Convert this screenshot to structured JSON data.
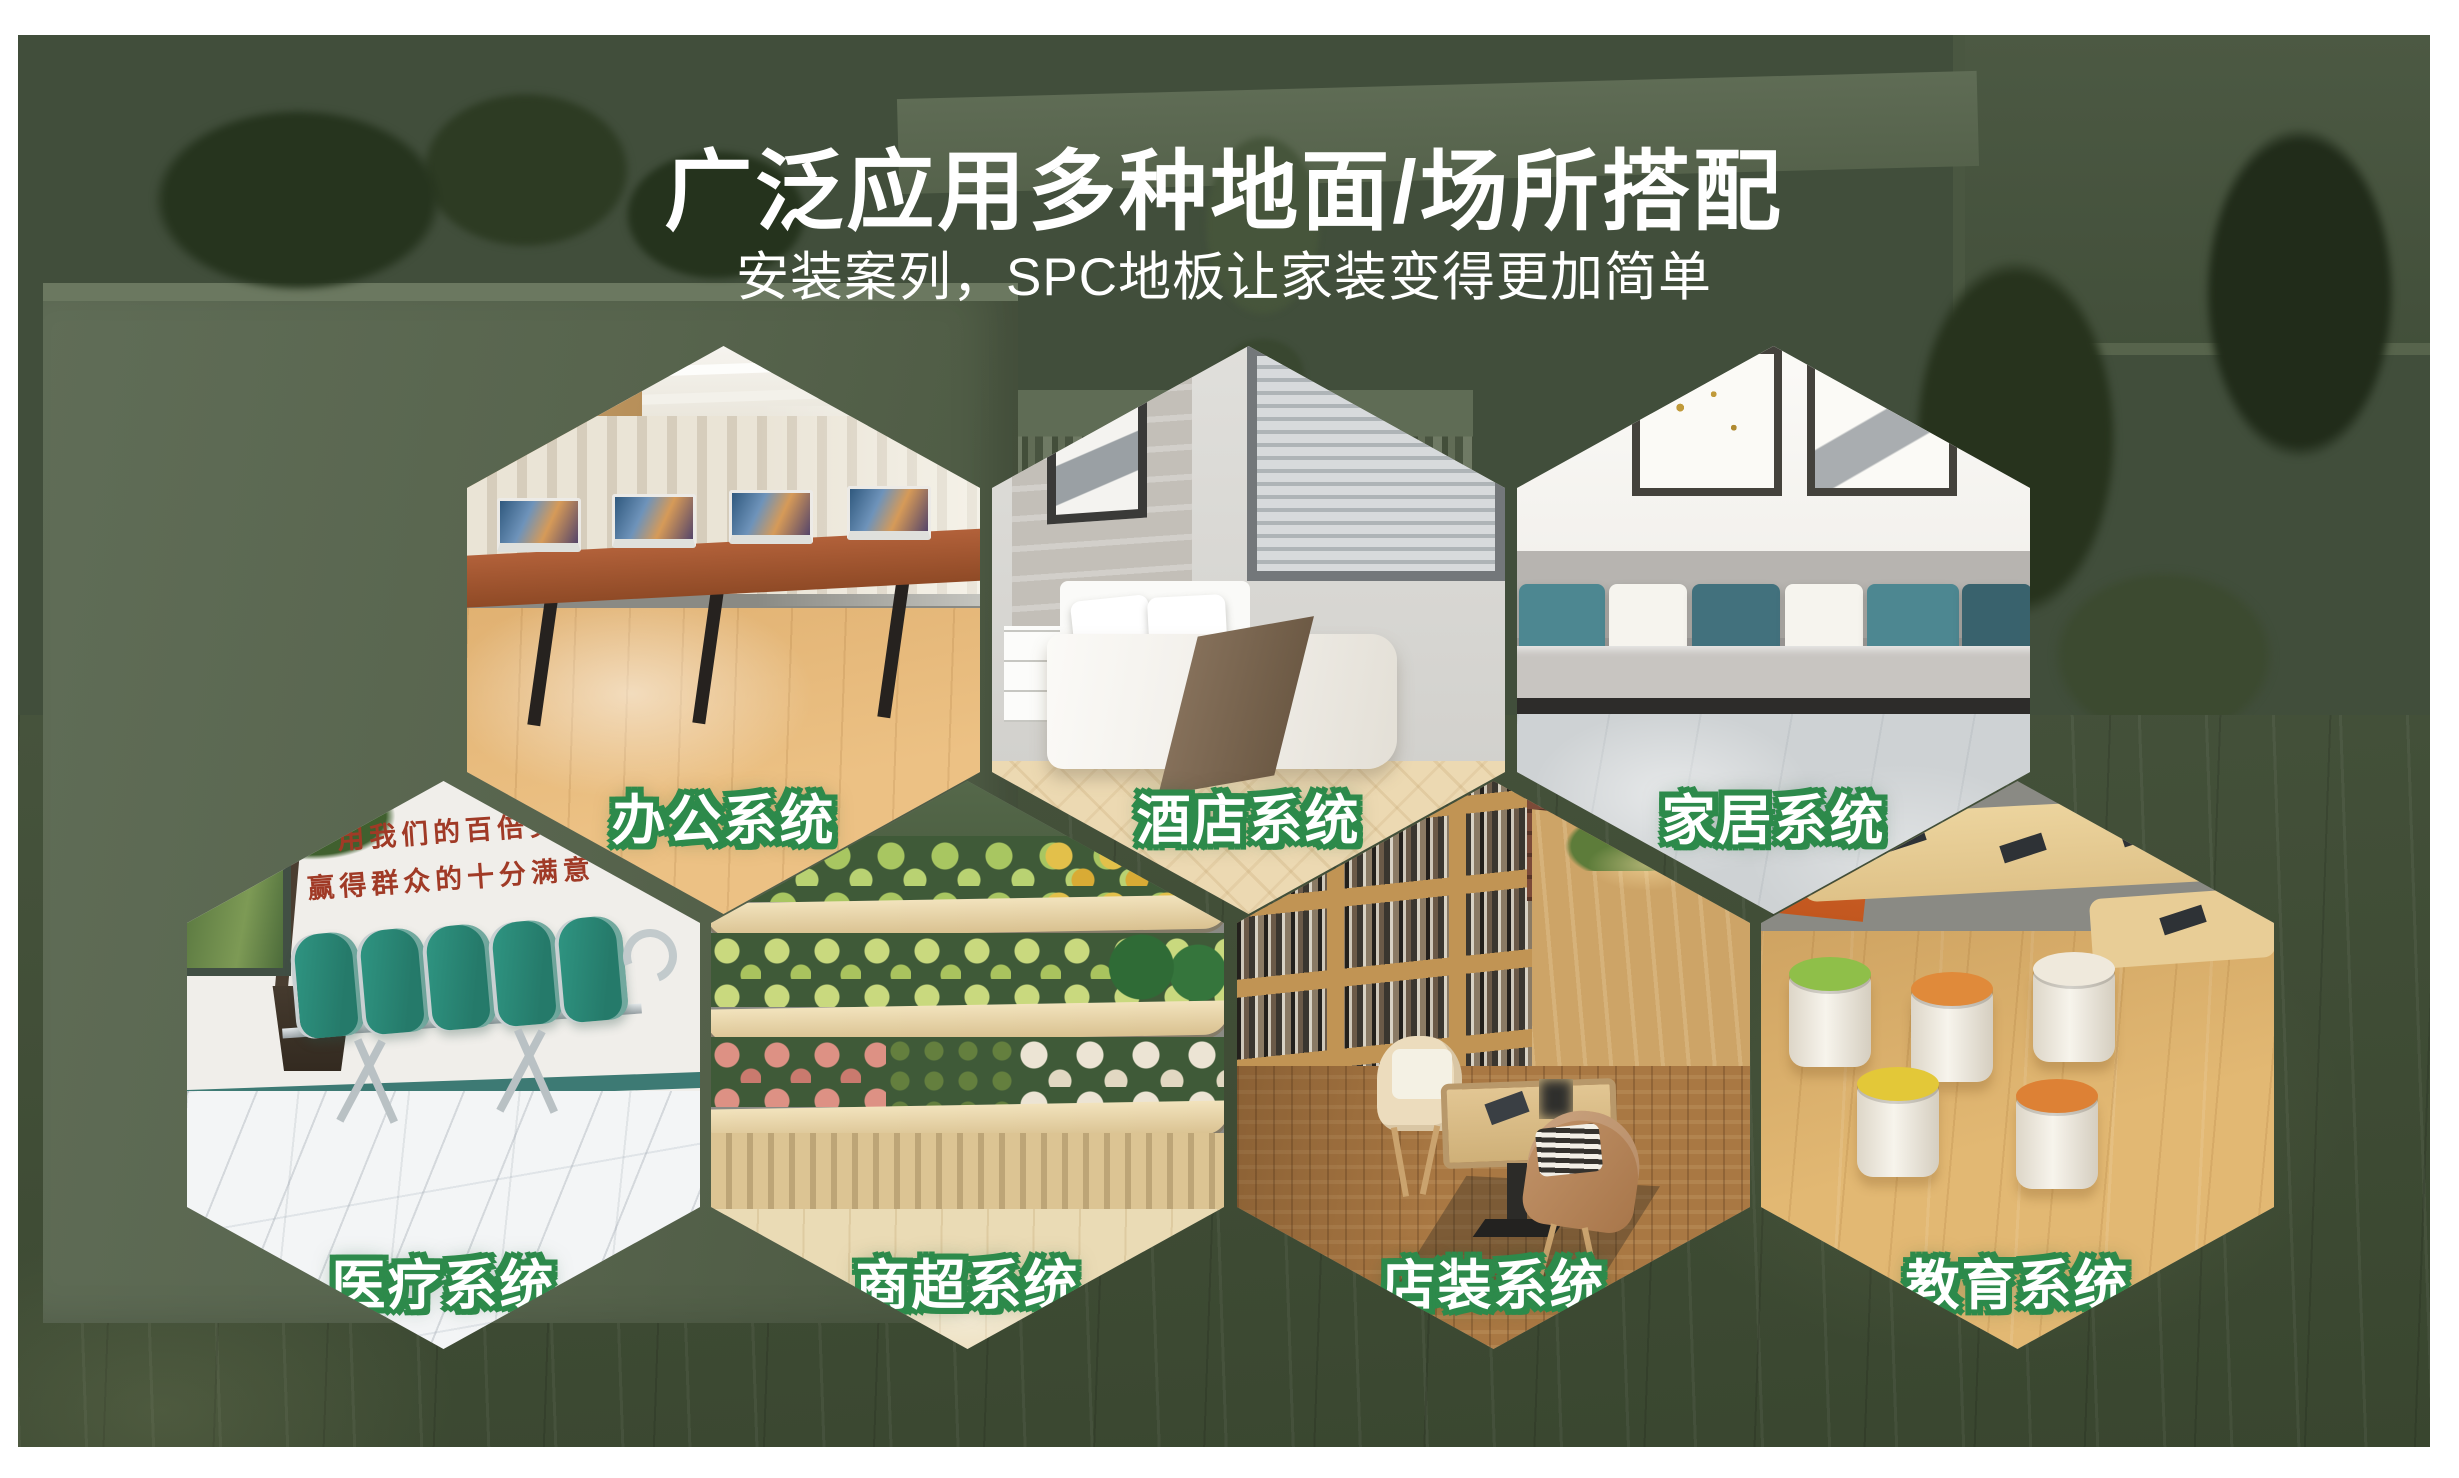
{
  "poster": {
    "title": "广泛应用多种地面/场所搭配",
    "subtitle": "安装案列，SPC地板让家装变得更加简单",
    "colors": {
      "accent_green": "#2d8a4b",
      "background_green": "#414e3b",
      "frame_white": "#ffffff",
      "text_white": "#ffffff"
    },
    "hexagons": [
      {
        "id": "office",
        "label": "办公系统"
      },
      {
        "id": "hotel",
        "label": "酒店系统"
      },
      {
        "id": "home",
        "label": "家居系统"
      },
      {
        "id": "medical",
        "label": "医疗系统"
      },
      {
        "id": "supermarket",
        "label": "商超系统"
      },
      {
        "id": "store",
        "label": "店装系统"
      },
      {
        "id": "education",
        "label": "教育系统"
      }
    ],
    "medical_wall_slogan": {
      "line1": "用我们的百倍努力",
      "line2": "赢得群众的十分满意"
    }
  }
}
